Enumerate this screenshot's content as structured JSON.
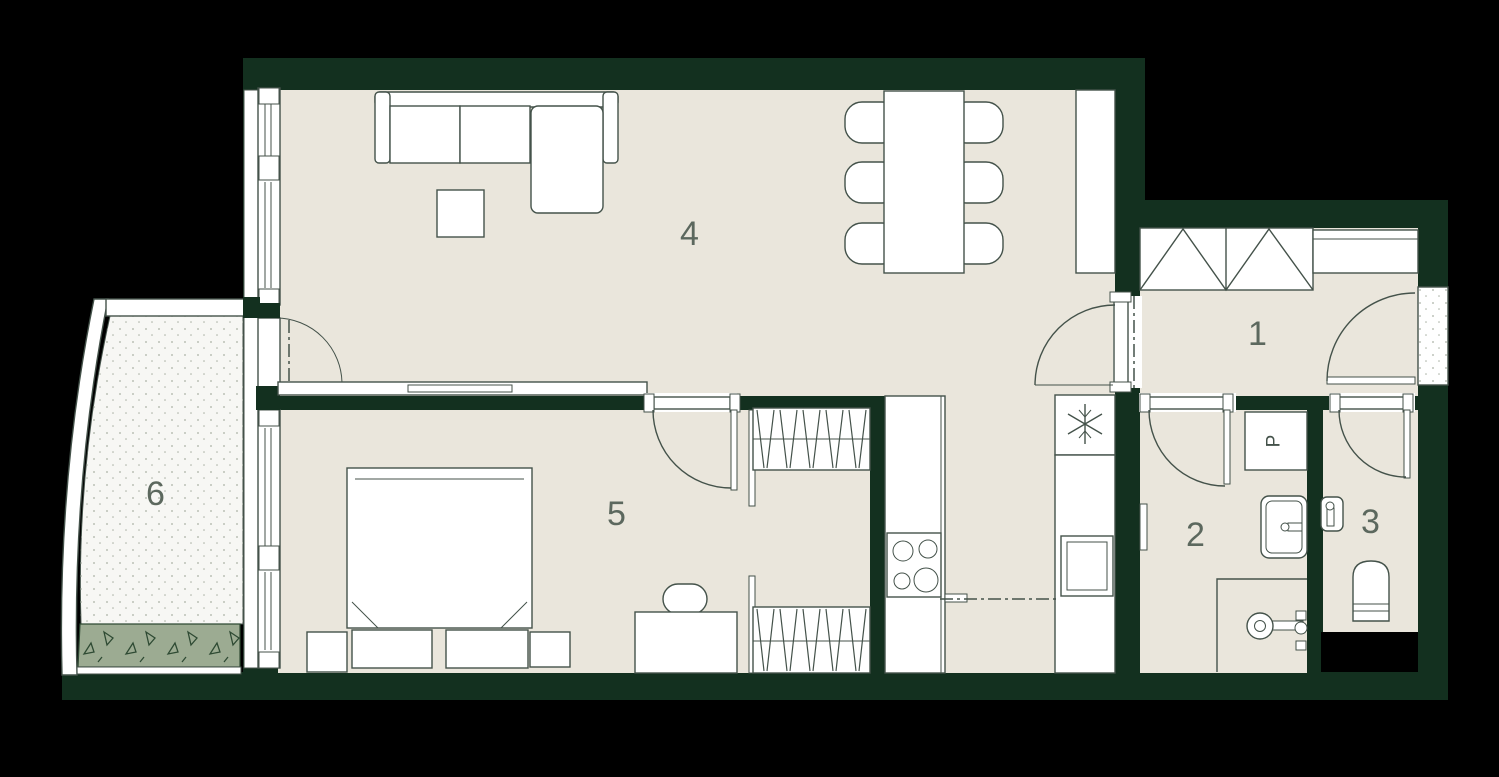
{
  "title": "apartment-floor-plan",
  "palette": {
    "background": "#000000",
    "wall_color": "#13301f",
    "floor_color": "#eae6dc",
    "line_color": "#44524a",
    "white": "#ffffff",
    "label_color": "#5c685e",
    "balcony_floor": "#f7f7f4",
    "speckle": "#a9b0a4",
    "planter": "#9cab92",
    "planter_line": "#2e4a33",
    "shaft": "#000000"
  },
  "rooms": {
    "hall": {
      "number": "1"
    },
    "bathroom": {
      "number": "2"
    },
    "wc": {
      "number": "3"
    },
    "living": {
      "number": "4"
    },
    "bedroom": {
      "number": "5"
    },
    "balcony": {
      "number": "6"
    }
  },
  "appliances": {
    "washer_label": "P"
  }
}
